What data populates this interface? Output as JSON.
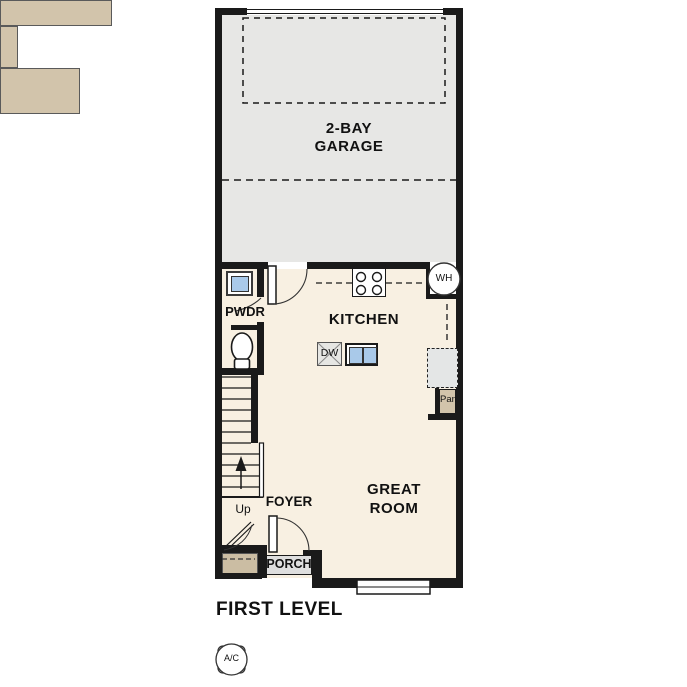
{
  "title": "FIRST LEVEL",
  "rooms": {
    "garage": {
      "line1": "2-BAY",
      "line2": "GARAGE"
    },
    "kitchen": "KITCHEN",
    "great_room": {
      "line1": "GREAT",
      "line2": "ROOM"
    },
    "powder_room": "PWDR",
    "foyer": "FOYER",
    "porch": "PORCH"
  },
  "labels": {
    "water_heater": "WH",
    "dishwasher": "DW",
    "pantry": "Pan",
    "ac_unit": "A/C",
    "stairs_up": "Up"
  },
  "colors": {
    "walls": "#1a1a1a",
    "garage_floor": "#e7e7e5",
    "interior_floor": "#f8f0e2",
    "counters": "#d2c4ab",
    "fixture_blue": "#a9c9e9",
    "appliance_gray": "#e4e6e6"
  }
}
